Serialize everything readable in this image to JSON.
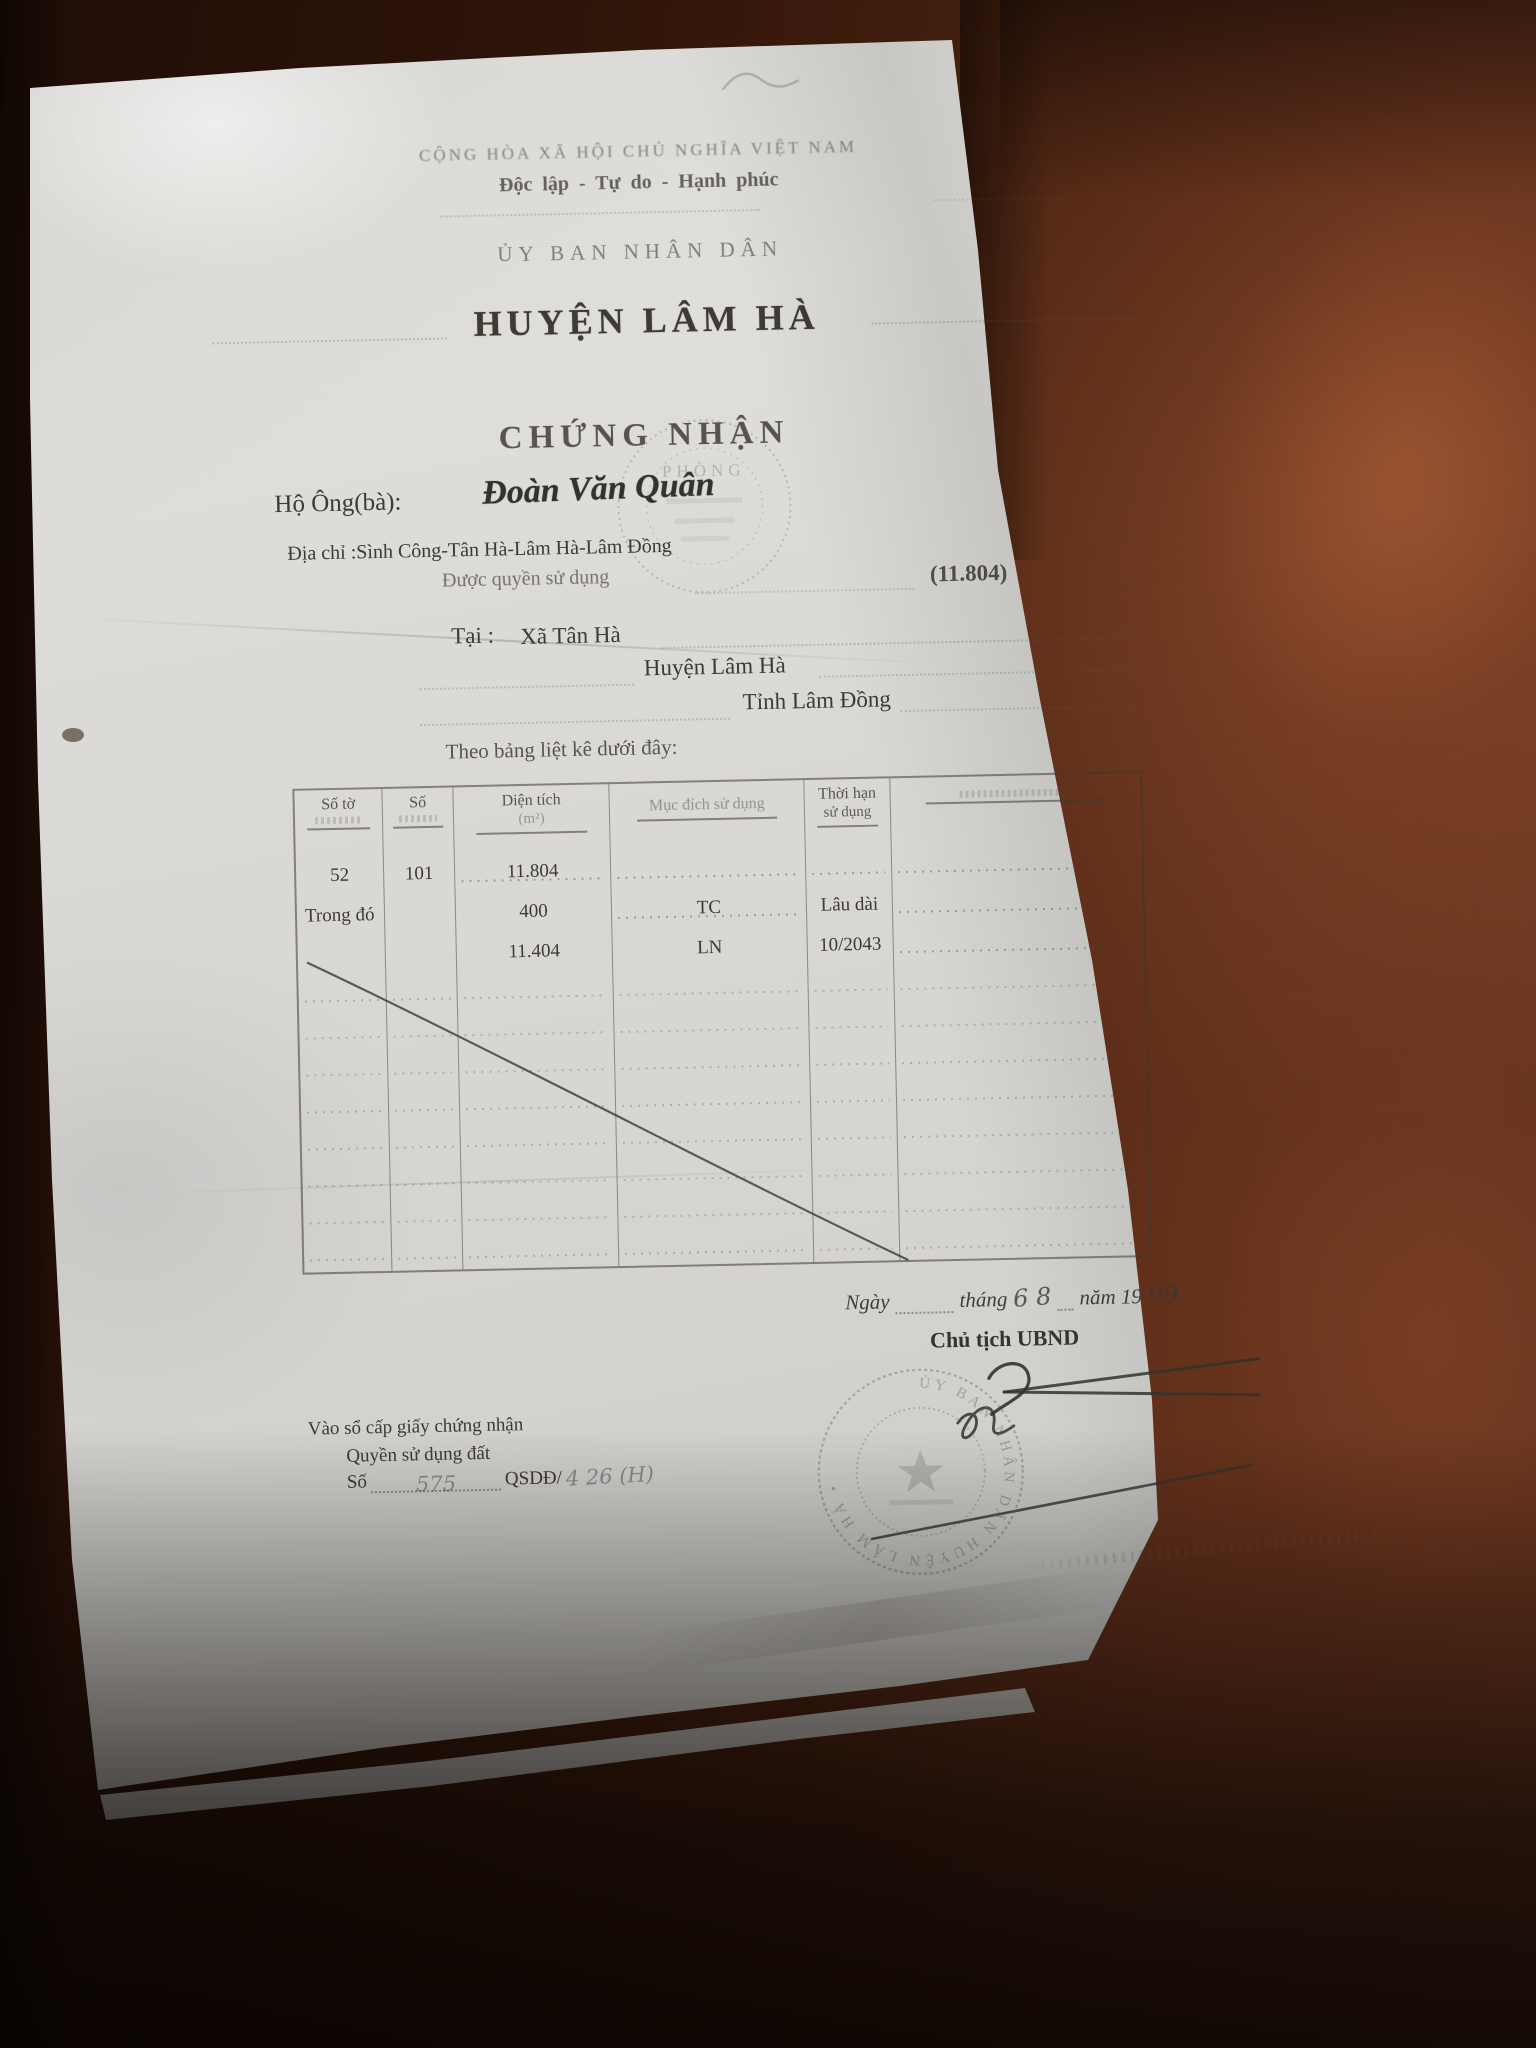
{
  "doc": {
    "nation_line1": "CỘNG HÒA XÃ HỘI CHỦ NGHĨA VIỆT NAM",
    "nation_line2": "Độc lập - Tự do - Hạnh phúc",
    "issuer_line1": "ỦY BAN NHÂN DÂN",
    "issuer_line2": "HUYỆN LÂM HÀ",
    "title": "CHỨNG NHẬN",
    "holder_label": "Hộ Ông(bà):",
    "holder_name": "Đoàn Văn Quân",
    "address_line": "Địa chỉ :Sình Công-Tân Hà-Lâm Hà-Lâm Đồng",
    "grant_label": "Được quyền sử dụng",
    "grant_area": "(11.804)",
    "at_label": "Tại :",
    "at_commune": "Xã Tân Hà",
    "at_district": "Huyện Lâm Hà",
    "at_province": "Tỉnh Lâm Đồng",
    "table_intro": "Theo bảng liệt kê dưới đây:",
    "table": {
      "h_so_to": "Số tờ",
      "h_so": "Số",
      "h_dien_tich": "Diện tích",
      "h_dien_tich_2": "(m²)",
      "h_muc_dich": "Mục đích sử dụng",
      "h_thoi_han": "Thời hạn",
      "h_thoi_han_2": "sử dụng",
      "h_ghi_chu": "",
      "r1c1": "52",
      "r1c2": "101",
      "r1c3": "11.804",
      "r2c1": "Trong đó",
      "r2c3": "400",
      "r2c4": "TC",
      "r2c5": "Lâu dài",
      "r3c3": "11.404",
      "r3c4": "LN",
      "r3c5": "10/2043"
    },
    "date": {
      "ngay": "Ngày",
      "thang": "tháng",
      "thang_hand": "6 8",
      "nam": "năm 19",
      "nam_hand": "99."
    },
    "signer_title": "Chủ tịch UBND",
    "registry_line1": "Vào sổ cấp giấy chứng nhận",
    "registry_line2": "Quyền sử dụng đất",
    "registry_so": "Số",
    "registry_so_hand": "575",
    "registry_qsdd": "QSDĐ/",
    "registry_qsdd_hand": "4 26 (H)",
    "stamp_top": "PHÒNG",
    "stamp_bottom": "ỦY BAN NHÂN DÂN HUYỆN LÂM HÀ •"
  }
}
